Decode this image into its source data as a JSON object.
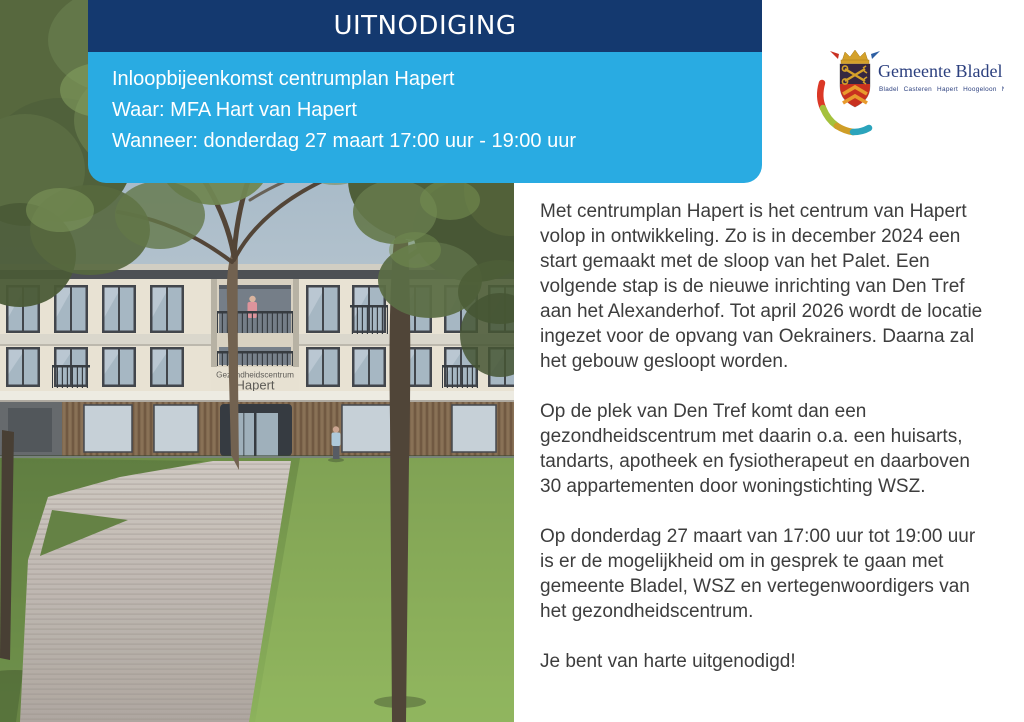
{
  "invitation_card": {
    "title": "UITNODIGING",
    "bar_color": "#14396f",
    "panel_color": "#29abe2",
    "line1": "Inloopbijeenkomst centrumplan Hapert",
    "line2": "Waar: MFA Hart van Hapert",
    "line3": "Wanneer: donderdag 27 maart 17:00 uur - 19:00 uur"
  },
  "logo": {
    "municipality": "Gemeente Bladel",
    "villages": "Bladel Casteren Hapert Hoogeloon Netersel",
    "text_color": "#2b3f7e",
    "swoosh_colors": [
      "#db3826",
      "#a4c13c",
      "#cf9e27",
      "#2ba4bc"
    ],
    "shield_colors": {
      "crown": "#d4a12a",
      "chief": "#352740",
      "base": "#c8311f",
      "chevrons": "#e89b2d"
    }
  },
  "photo": {
    "building_sign_line1": "Gezondheidscentrum",
    "building_sign_line2": "Hapert"
  },
  "body": {
    "text_color": "#3d3d3d",
    "paragraphs": [
      "Met centrumplan Hapert is het centrum van Hapert\nvolop in ontwikkeling. Zo is in december 2024 een\nstart gemaakt met de sloop van het Palet. Een\nvolgende stap is de nieuwe inrichting van Den Tref\naan het Alexanderhof. Tot april 2026 wordt de locatie\ningezet voor de opvang van Oekrainers. Daarna zal\nhet gebouw gesloopt worden.",
      "Op de plek van Den Tref komt dan een\ngezondheidscentrum met daarin o.a. een huisarts,\ntandarts, apotheek en fysiotherapeut en daarboven\n30 appartementen door woningstichting WSZ.",
      "Op donderdag 27 maart van 17:00 uur tot 19:00 uur\nis er de mogelijkheid om in gesprek te gaan met\ngemeente Bladel, WSZ en vertegenwoordigers van\nhet gezondheidscentrum.",
      "Je bent van harte uitgenodigd!"
    ]
  }
}
